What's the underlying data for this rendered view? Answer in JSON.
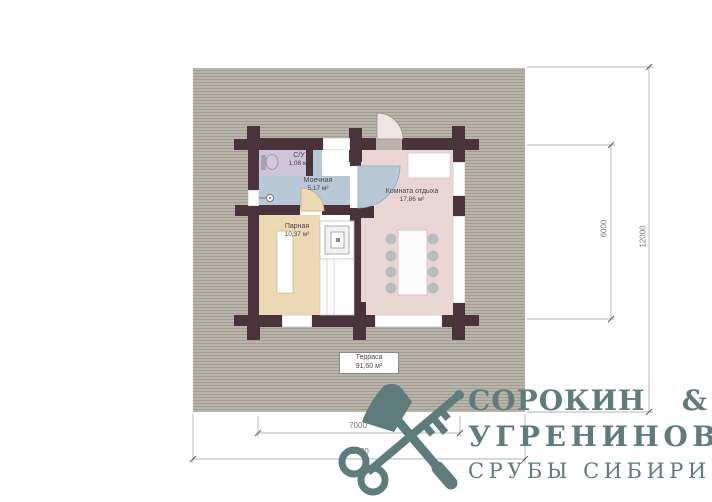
{
  "plan": {
    "terrace": {
      "name": "Терраса",
      "area": "91,60 м²"
    },
    "rooms": [
      {
        "name": "С/У",
        "area": "1,08 м²",
        "color": "#cdc4da"
      },
      {
        "name": "Моечная",
        "area": "5,17 м²",
        "color": "#b7c9d6"
      },
      {
        "name": "Парная",
        "area": "10,37 м²",
        "color": "#ecd9b4"
      },
      {
        "name": "Комната отдыха",
        "area": "17,86 м²",
        "color": "#e9d6d4"
      }
    ],
    "colors": {
      "wall": "#4a333a",
      "terrace_base": "#b5b0a5",
      "threshold": "#b9b3ab"
    }
  },
  "dimensions": {
    "building_width": "7000",
    "site_width": "11500",
    "building_depth": "6000",
    "site_depth": "12000"
  },
  "logo": {
    "line1": "СОРОКИН",
    "ampersand": "&",
    "line2": "УГРЕНИНОВ",
    "line3": "СРУБЫ СИБИРИ",
    "color": "#5e7c7c"
  }
}
